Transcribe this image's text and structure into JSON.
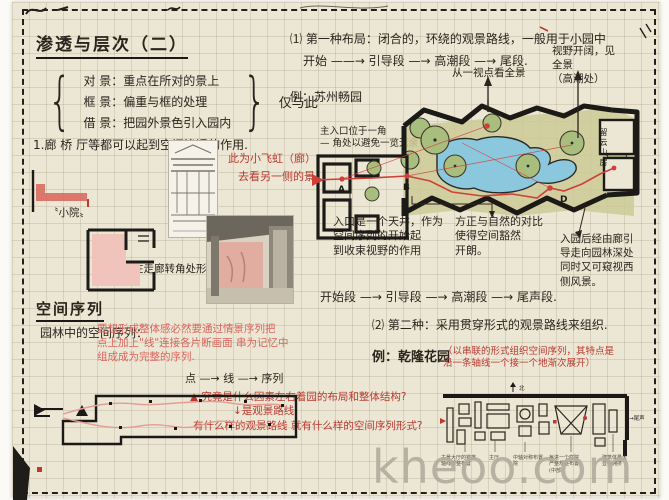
{
  "watermark": "kheoo.com",
  "colors": {
    "ink": "#2b241d",
    "red": "#b9392f",
    "pink_red": "#d9655c",
    "pond_blue": "#8cc8dd",
    "tree_green": "#a9bd7e",
    "paper": "#ece6d5",
    "watermark_gray": "#b3ada0",
    "route_red": "#cf4038"
  },
  "title": "渗透与层次（二）",
  "jing": {
    "items": [
      {
        "text": "对 景：重点在所对的景上"
      },
      {
        "text": "框 景：偏重与框的处理"
      },
      {
        "text": "借 景：把园外景色引入园内"
      }
    ],
    "aside": "仅与此"
  },
  "penetration": {
    "line": "1.廊 桥 厅等都可以起到空间渗透的作用.",
    "red_note1": "此为小飞虹（廊）",
    "red_note2": "去看另一侧的景.",
    "court_label": "〝小院〟",
    "corner_caption": "在走廊转角处形成L形的小院"
  },
  "type1": {
    "heading": "⑴ 第一种布局：闭合的，环绕的观景路线，一般用于小园中",
    "flow": "开始 ——→ 引导段 —→ 高潮段 —→ 尾段.",
    "example": "例：苏州畅园",
    "viewpoint_note": "从一视点看全景",
    "vista_note": "视野开阔，见\n全景\n（高潮处）",
    "entrance_note": "主入口位于一角\n— 角处以避免一览无余",
    "courtyard_note": "入口是一个天井，作为\n空间序列的开始起\n到收束视野的作用",
    "contrast_note": "方正与自然的对比\n使得空间豁然\n开朗。",
    "corridor_note": "入园后经由廊引\n导走向园林深处\n同时又可窥视西\n侧风景。",
    "flow2": "开始段 —→ 引导段 —→ 高潮段 —→ 尾声段.",
    "plan_labels": {
      "a": "A",
      "b": "B",
      "d": "D",
      "hall": "留云山房"
    }
  },
  "sequence": {
    "heading": "空间序列",
    "lead": "园林中的空间序列：",
    "red_para": "要想形成整体感必然要通过情景序列把\n点上加上\"线\"连接各片断画面 串为记忆中\n组成成为完整的序列.",
    "chain": "点 —→ 线 —→ 序列",
    "q1": "▲ 究竟是什么因素左右着园的布局和整体结构?",
    "q2": "↓是观景路线",
    "q3": "有什么样的观景路线 就有什么样的空间序列形式?"
  },
  "type2": {
    "heading": "⑵ 第二种：采用贯穿形式的观景路线来组织.",
    "example": "例：乾隆花园",
    "red_note": "（以串联的形式组织空间序列，其特点是\n沿一条轴线一个接一个地渐次展开）",
    "north": "北",
    "end_label": "→尾声",
    "plan_labels": [
      "主景大厅的错落\n轴线规整布置",
      "主厅",
      "中轴对称布置\n院",
      "每进一个庭院\n严整规整布置\n(中部)",
      "建筑体量大\n显得拥挤"
    ]
  }
}
